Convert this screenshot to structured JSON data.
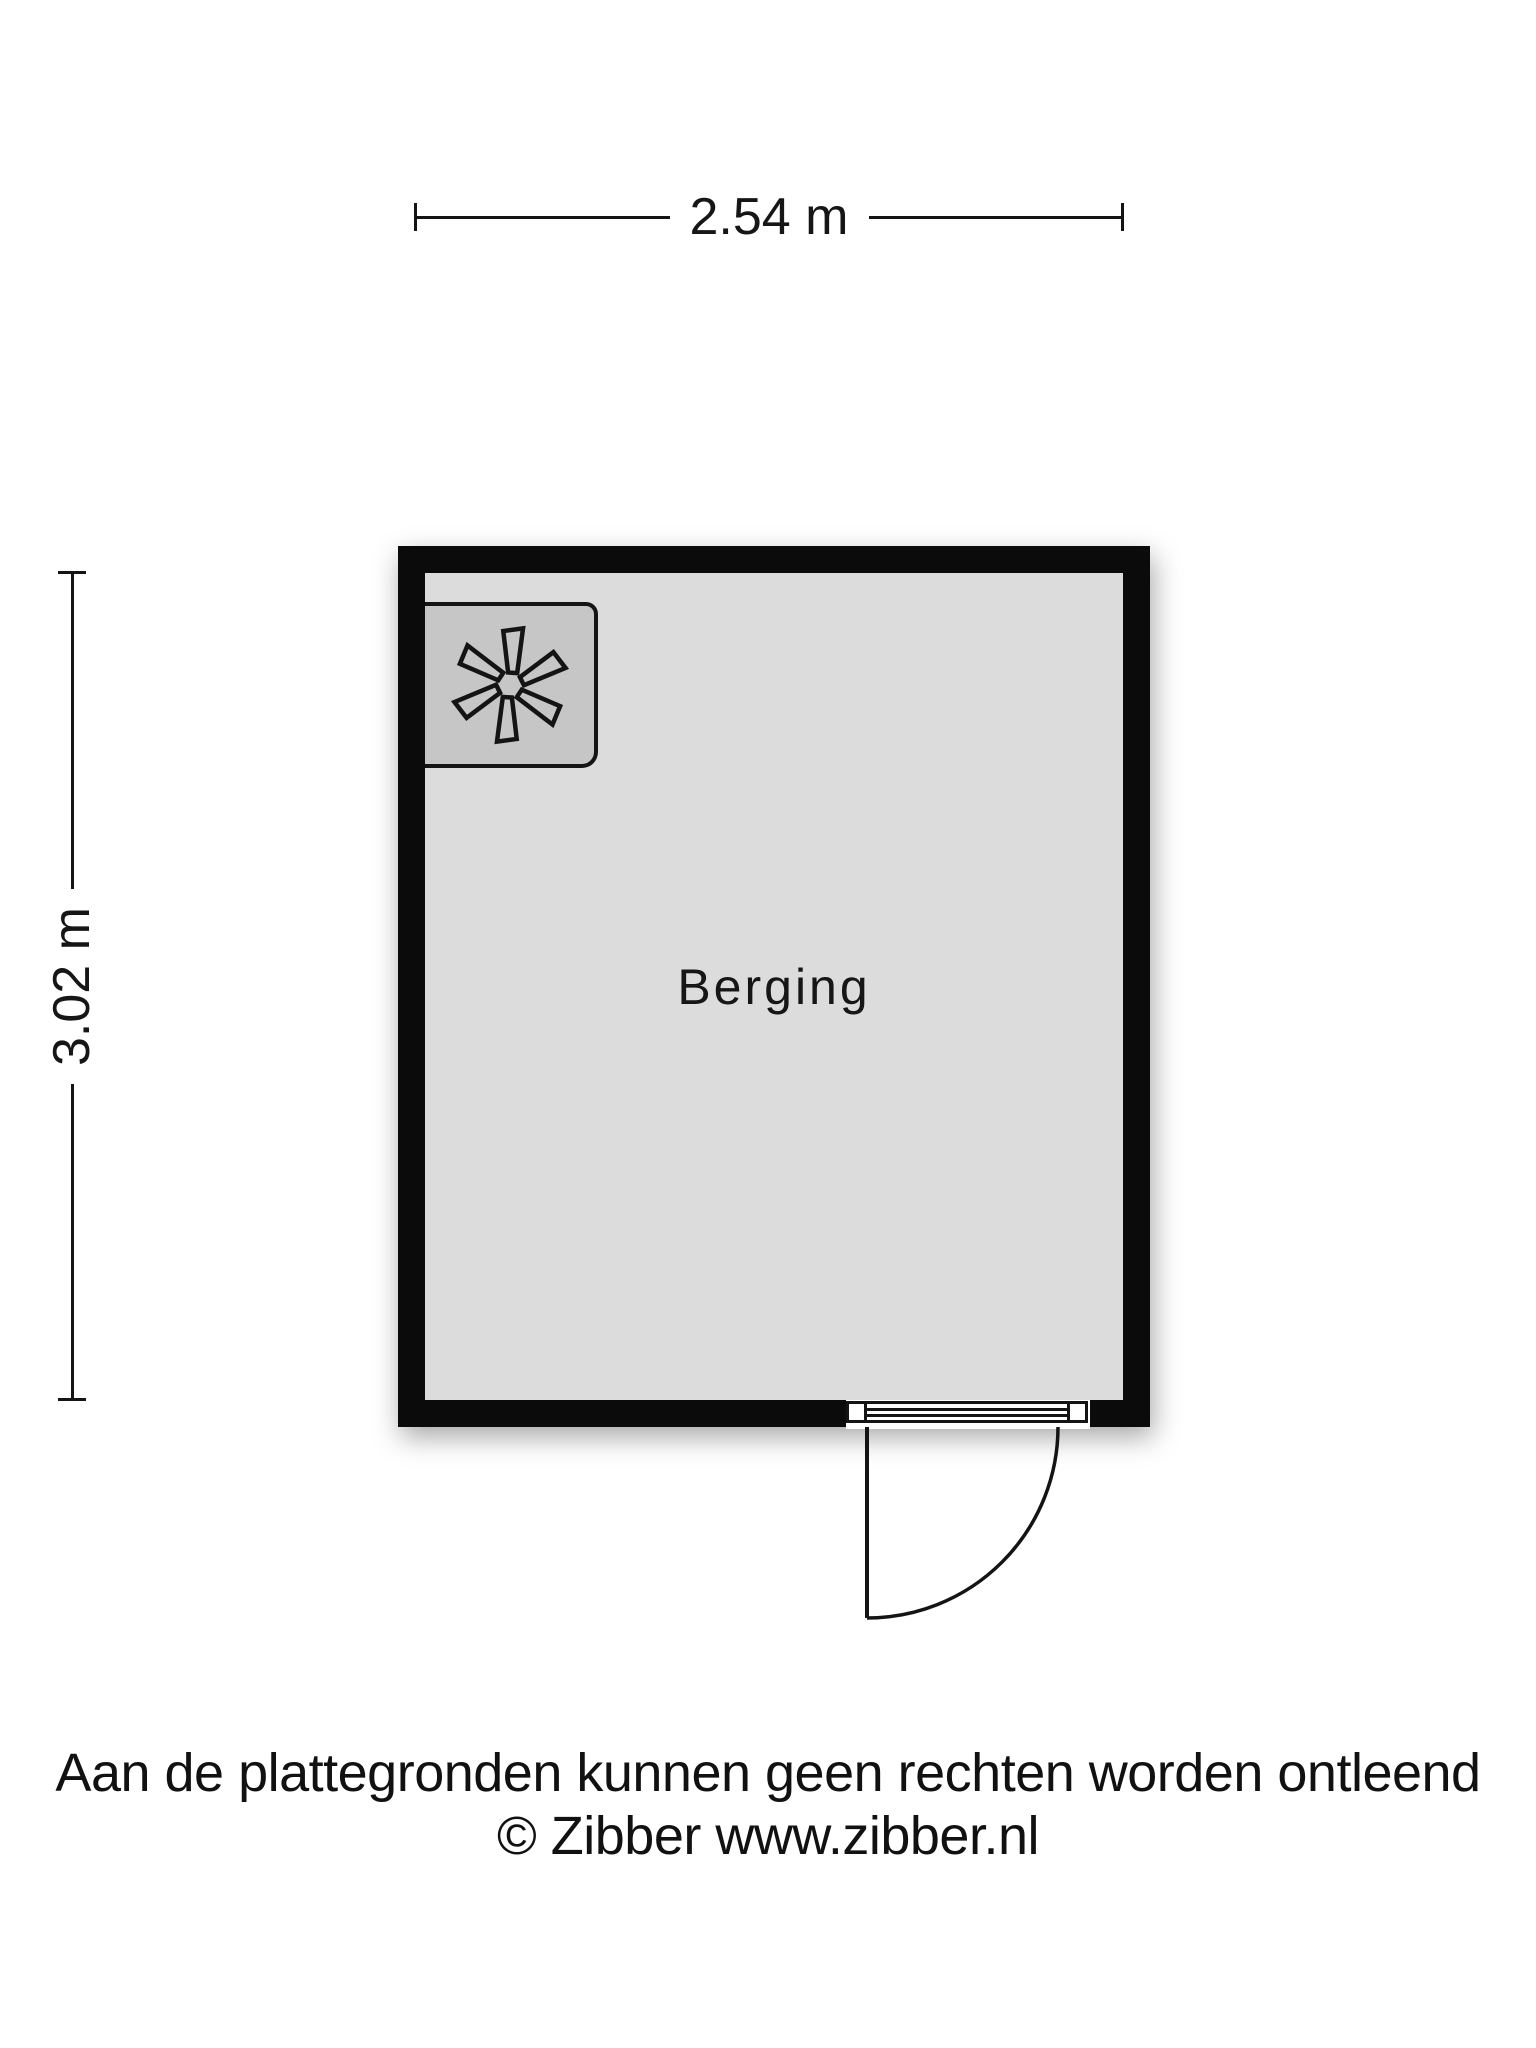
{
  "plan": {
    "room": {
      "label": "Berging"
    },
    "dimensions": {
      "width": "2.54 m",
      "height": "3.02 m"
    },
    "fixtures": [
      {
        "name": "mechanical-ventilation-unit",
        "icon": "fan-icon",
        "position": "top-left"
      }
    ],
    "door": {
      "type": "single-swing",
      "hinge": "left",
      "swing": "outward-bottom"
    }
  },
  "footer": {
    "disclaimer": "Aan de plattegronden kunnen geen rechten worden ontleend",
    "copyright": "© Zibber www.zibber.nl"
  },
  "colors": {
    "wall": "#0b0b0b",
    "floor": "#dcdcdc",
    "unit": "#c6c6c6",
    "line": "#141414",
    "text": "#161616",
    "background": "#ffffff"
  }
}
